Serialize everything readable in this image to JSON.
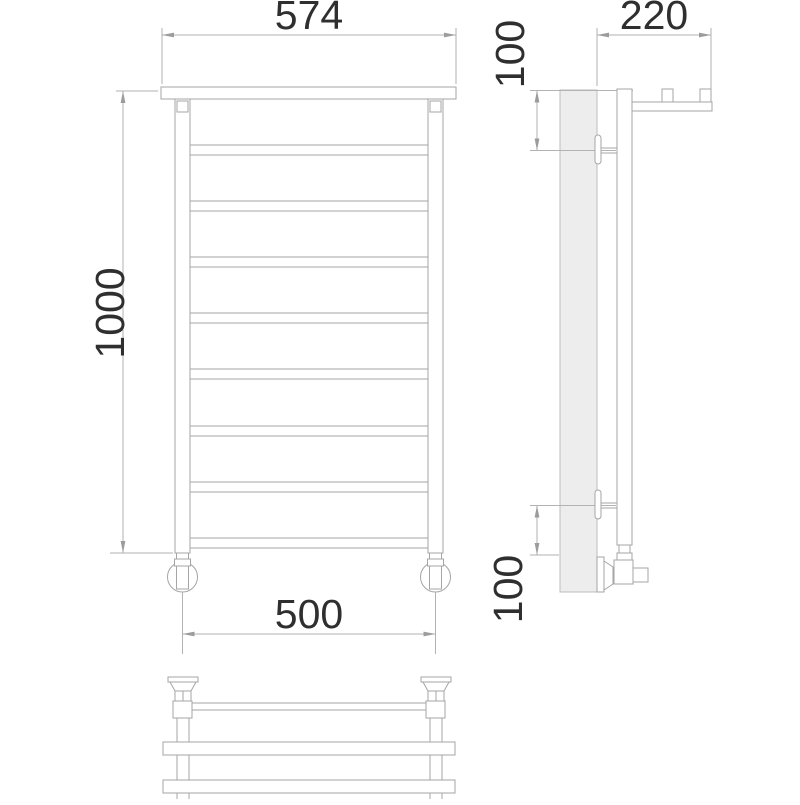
{
  "dimensions": {
    "front": {
      "shelf_width": "574",
      "height": "1000",
      "pipe_spacing": "500",
      "rung_count": 8
    },
    "side": {
      "depth": "220",
      "top_offset": "100",
      "bottom_offset": "100"
    }
  },
  "colors": {
    "object_line": "#a5a5a5",
    "dimension_line": "#b2b2b2",
    "arrow": "#9c9c9c",
    "text": "#2f2f2f",
    "wall_fill": "#ededed",
    "background": "#ffffff"
  }
}
